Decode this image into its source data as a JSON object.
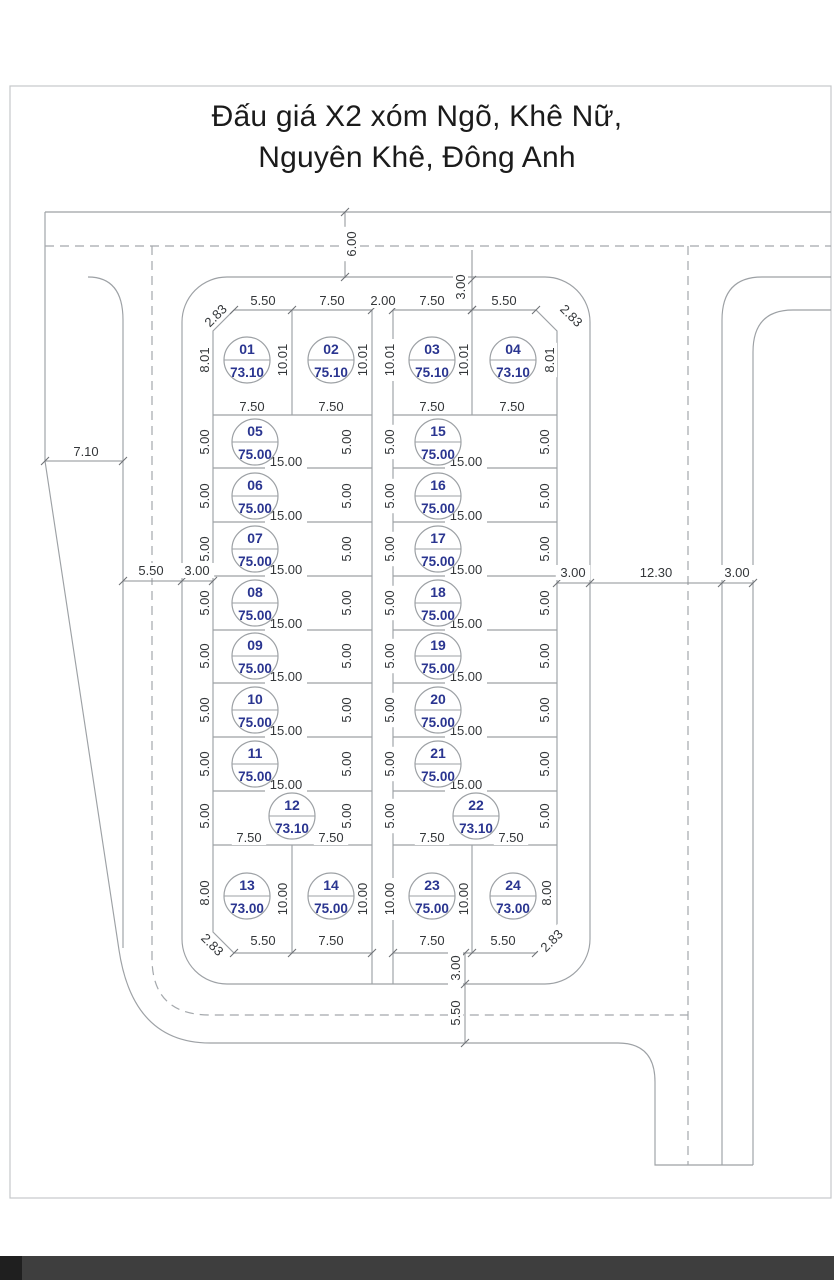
{
  "title": {
    "line1": "Đấu giá X2 xóm Ngõ, Khê Nữ,",
    "line2": "Nguyên Khê, Đông Anh"
  },
  "colors": {
    "plot_label": "#2a3590",
    "drawing_line": "#9da1a5",
    "dimension_text": "#333639",
    "footer_band": "#3e3e3e",
    "footer_band_corner": "#1f1f1f"
  },
  "plot_circle_radius": 23,
  "plots": [
    {
      "no": "01",
      "area": "73.10",
      "cx": 247,
      "cy": 360
    },
    {
      "no": "02",
      "area": "75.10",
      "cx": 331,
      "cy": 360
    },
    {
      "no": "03",
      "area": "75.10",
      "cx": 432,
      "cy": 360
    },
    {
      "no": "04",
      "area": "73.10",
      "cx": 513,
      "cy": 360
    },
    {
      "no": "05",
      "area": "75.00",
      "cx": 255,
      "cy": 442
    },
    {
      "no": "06",
      "area": "75.00",
      "cx": 255,
      "cy": 496
    },
    {
      "no": "07",
      "area": "75.00",
      "cx": 255,
      "cy": 549
    },
    {
      "no": "08",
      "area": "75.00",
      "cx": 255,
      "cy": 603
    },
    {
      "no": "09",
      "area": "75.00",
      "cx": 255,
      "cy": 656
    },
    {
      "no": "10",
      "area": "75.00",
      "cx": 255,
      "cy": 710
    },
    {
      "no": "11",
      "area": "75.00",
      "cx": 255,
      "cy": 764
    },
    {
      "no": "12",
      "area": "73.10",
      "cx": 292,
      "cy": 816
    },
    {
      "no": "13",
      "area": "73.00",
      "cx": 247,
      "cy": 896
    },
    {
      "no": "14",
      "area": "75.00",
      "cx": 331,
      "cy": 896
    },
    {
      "no": "15",
      "area": "75.00",
      "cx": 438,
      "cy": 442
    },
    {
      "no": "16",
      "area": "75.00",
      "cx": 438,
      "cy": 496
    },
    {
      "no": "17",
      "area": "75.00",
      "cx": 438,
      "cy": 549
    },
    {
      "no": "18",
      "area": "75.00",
      "cx": 438,
      "cy": 603
    },
    {
      "no": "19",
      "area": "75.00",
      "cx": 438,
      "cy": 656
    },
    {
      "no": "20",
      "area": "75.00",
      "cx": 438,
      "cy": 710
    },
    {
      "no": "21",
      "area": "75.00",
      "cx": 438,
      "cy": 764
    },
    {
      "no": "22",
      "area": "73.10",
      "cx": 476,
      "cy": 816
    },
    {
      "no": "23",
      "area": "75.00",
      "cx": 432,
      "cy": 896
    },
    {
      "no": "24",
      "area": "73.00",
      "cx": 513,
      "cy": 896
    }
  ],
  "dims": [
    [
      "6.00",
      352,
      244,
      -90
    ],
    [
      "5.50",
      263,
      301,
      0
    ],
    [
      "7.50",
      332,
      301,
      0
    ],
    [
      "2.00",
      383,
      301,
      0
    ],
    [
      "7.50",
      432,
      301,
      0
    ],
    [
      "5.50",
      504,
      301,
      0
    ],
    [
      "3.00",
      461,
      287,
      -90
    ],
    [
      "2.83",
      216,
      316,
      -45
    ],
    [
      "2.83",
      571,
      316,
      45
    ],
    [
      "8.01",
      205,
      360,
      -90
    ],
    [
      "10.01",
      283,
      360,
      -90
    ],
    [
      "10.01",
      363,
      360,
      -90
    ],
    [
      "10.01",
      390,
      360,
      -90
    ],
    [
      "10.01",
      464,
      360,
      -90
    ],
    [
      "8.01",
      550,
      360,
      -90
    ],
    [
      "7.50",
      252,
      407,
      0
    ],
    [
      "7.50",
      331,
      407,
      0
    ],
    [
      "7.50",
      432,
      407,
      0
    ],
    [
      "7.50",
      512,
      407,
      0
    ],
    [
      "5.00",
      205,
      442,
      -90
    ],
    [
      "5.00",
      347,
      442,
      -90
    ],
    [
      "5.00",
      390,
      442,
      -90
    ],
    [
      "5.00",
      545,
      442,
      -90
    ],
    [
      "15.00",
      286,
      462,
      0
    ],
    [
      "15.00",
      466,
      462,
      0
    ],
    [
      "5.00",
      205,
      496,
      -90
    ],
    [
      "5.00",
      347,
      496,
      -90
    ],
    [
      "5.00",
      390,
      496,
      -90
    ],
    [
      "5.00",
      545,
      496,
      -90
    ],
    [
      "15.00",
      286,
      516,
      0
    ],
    [
      "15.00",
      466,
      516,
      0
    ],
    [
      "5.00",
      205,
      549,
      -90
    ],
    [
      "5.00",
      347,
      549,
      -90
    ],
    [
      "5.00",
      390,
      549,
      -90
    ],
    [
      "5.00",
      545,
      549,
      -90
    ],
    [
      "15.00",
      286,
      570,
      0
    ],
    [
      "15.00",
      466,
      570,
      0
    ],
    [
      "5.00",
      205,
      603,
      -90
    ],
    [
      "5.00",
      347,
      603,
      -90
    ],
    [
      "5.00",
      390,
      603,
      -90
    ],
    [
      "5.00",
      545,
      603,
      -90
    ],
    [
      "15.00",
      286,
      624,
      0
    ],
    [
      "15.00",
      466,
      624,
      0
    ],
    [
      "5.00",
      205,
      656,
      -90
    ],
    [
      "5.00",
      347,
      656,
      -90
    ],
    [
      "5.00",
      390,
      656,
      -90
    ],
    [
      "5.00",
      545,
      656,
      -90
    ],
    [
      "15.00",
      286,
      677,
      0
    ],
    [
      "15.00",
      466,
      677,
      0
    ],
    [
      "5.00",
      205,
      710,
      -90
    ],
    [
      "5.00",
      347,
      710,
      -90
    ],
    [
      "5.00",
      390,
      710,
      -90
    ],
    [
      "5.00",
      545,
      710,
      -90
    ],
    [
      "15.00",
      286,
      731,
      0
    ],
    [
      "15.00",
      466,
      731,
      0
    ],
    [
      "5.00",
      205,
      764,
      -90
    ],
    [
      "5.00",
      347,
      764,
      -90
    ],
    [
      "5.00",
      390,
      764,
      -90
    ],
    [
      "5.00",
      545,
      764,
      -90
    ],
    [
      "15.00",
      286,
      785,
      0
    ],
    [
      "15.00",
      466,
      785,
      0
    ],
    [
      "5.00",
      205,
      816,
      -90
    ],
    [
      "5.00",
      347,
      816,
      -90
    ],
    [
      "5.00",
      390,
      816,
      -90
    ],
    [
      "5.00",
      545,
      816,
      -90
    ],
    [
      "7.50",
      249,
      838,
      0
    ],
    [
      "7.50",
      331,
      838,
      0
    ],
    [
      "7.50",
      432,
      838,
      0
    ],
    [
      "7.50",
      511,
      838,
      0
    ],
    [
      "8.00",
      205,
      893,
      -90
    ],
    [
      "10.00",
      283,
      899,
      -90
    ],
    [
      "10.00",
      363,
      899,
      -90
    ],
    [
      "10.00",
      390,
      899,
      -90
    ],
    [
      "10.00",
      464,
      899,
      -90
    ],
    [
      "8.00",
      547,
      893,
      -90
    ],
    [
      "5.50",
      263,
      941,
      0
    ],
    [
      "7.50",
      331,
      941,
      0
    ],
    [
      "7.50",
      432,
      941,
      0
    ],
    [
      "5.50",
      503,
      941,
      0
    ],
    [
      "2.83",
      212,
      945,
      45
    ],
    [
      "2.83",
      552,
      941,
      -45
    ],
    [
      "3.00",
      456,
      968,
      -90
    ],
    [
      "5.50",
      456,
      1013,
      -90
    ],
    [
      "7.10",
      86,
      452,
      0
    ],
    [
      "5.50",
      151,
      571,
      0
    ],
    [
      "3.00",
      197,
      571,
      0
    ],
    [
      "3.00",
      573,
      573,
      0
    ],
    [
      "12.30",
      656,
      573,
      0
    ],
    [
      "3.00",
      737,
      573,
      0
    ]
  ]
}
